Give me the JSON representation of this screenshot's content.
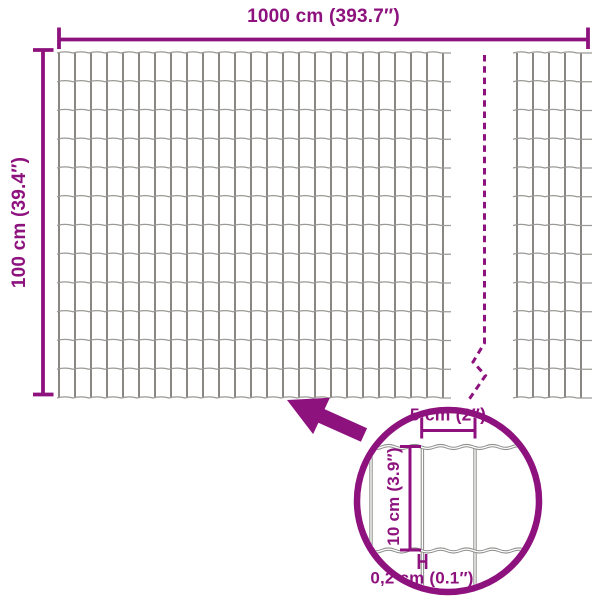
{
  "labels": {
    "total_width": "1000 cm (393.7″)",
    "total_height": "100 cm (39.4″)",
    "mesh_cell_width": "5 cm (2″)",
    "mesh_cell_height": "10 cm (3.9″)",
    "wire_thickness": "0,2 cm (0.1″)"
  },
  "colors": {
    "accent": "#8E127E",
    "wire_vertical": "#57534e",
    "wire_horizontal": "#9c9a96",
    "detail_wire": "#8e8e8c",
    "background": "#ffffff"
  },
  "geometry": {
    "mesh": {
      "row_top": 53,
      "row_bottom": 398,
      "rows": 12,
      "col_spacing": 16,
      "panels": [
        {
          "first_col_x": 59,
          "cols": 25,
          "wire_start_x": 57,
          "wire_end_x": 451
        },
        {
          "first_col_x": 517,
          "cols": 5,
          "wire_start_x": 513,
          "wire_end_x": 592
        }
      ]
    },
    "width_dim": {
      "y": 39.5,
      "x1": 59,
      "x2": 588,
      "tick_y1": 27.5,
      "tick_y2": 49
    },
    "height_dim": {
      "x": 43,
      "y1": 50,
      "y2": 394.5,
      "cap_x1": 33,
      "cap_x2": 53.5
    },
    "break_line": "M484.5 55 V343 L473 362 L485.5 375.5 L469 399.5",
    "arrow_points": "287,400 329.9,397.7 324.6,409.1 367.1,428.2 360.9,441.8 318.4,422.7 313.1,434.1",
    "detail": {
      "cx": 448,
      "cy": 501,
      "r": 91,
      "stroke_width": 6.5,
      "clip_r": 87.5,
      "h_wires_y": [
        447,
        550.5
      ],
      "wire_span_x1": 356,
      "wire_span_x2": 541,
      "v_wires": [
        {
          "x": 371,
          "y1": 446,
          "y2": 552
        },
        {
          "x": 422.4,
          "y1": 446,
          "y2": 590
        },
        {
          "x": 475,
          "y1": 446,
          "y2": 590
        }
      ],
      "width_dim": {
        "y": 430.5,
        "x1": 421.7,
        "x2": 475,
        "tick_y1": 411,
        "tick_y2": 438.5
      },
      "height_dim": {
        "x": 410,
        "y1": 446.5,
        "y2": 550,
        "cap_x1": 400,
        "cap_x2": 421
      },
      "thickness_marker": {
        "x1": 418.9,
        "x2": 426.1,
        "y1": 554,
        "y2": 569,
        "mid_y": 561.5
      }
    }
  }
}
